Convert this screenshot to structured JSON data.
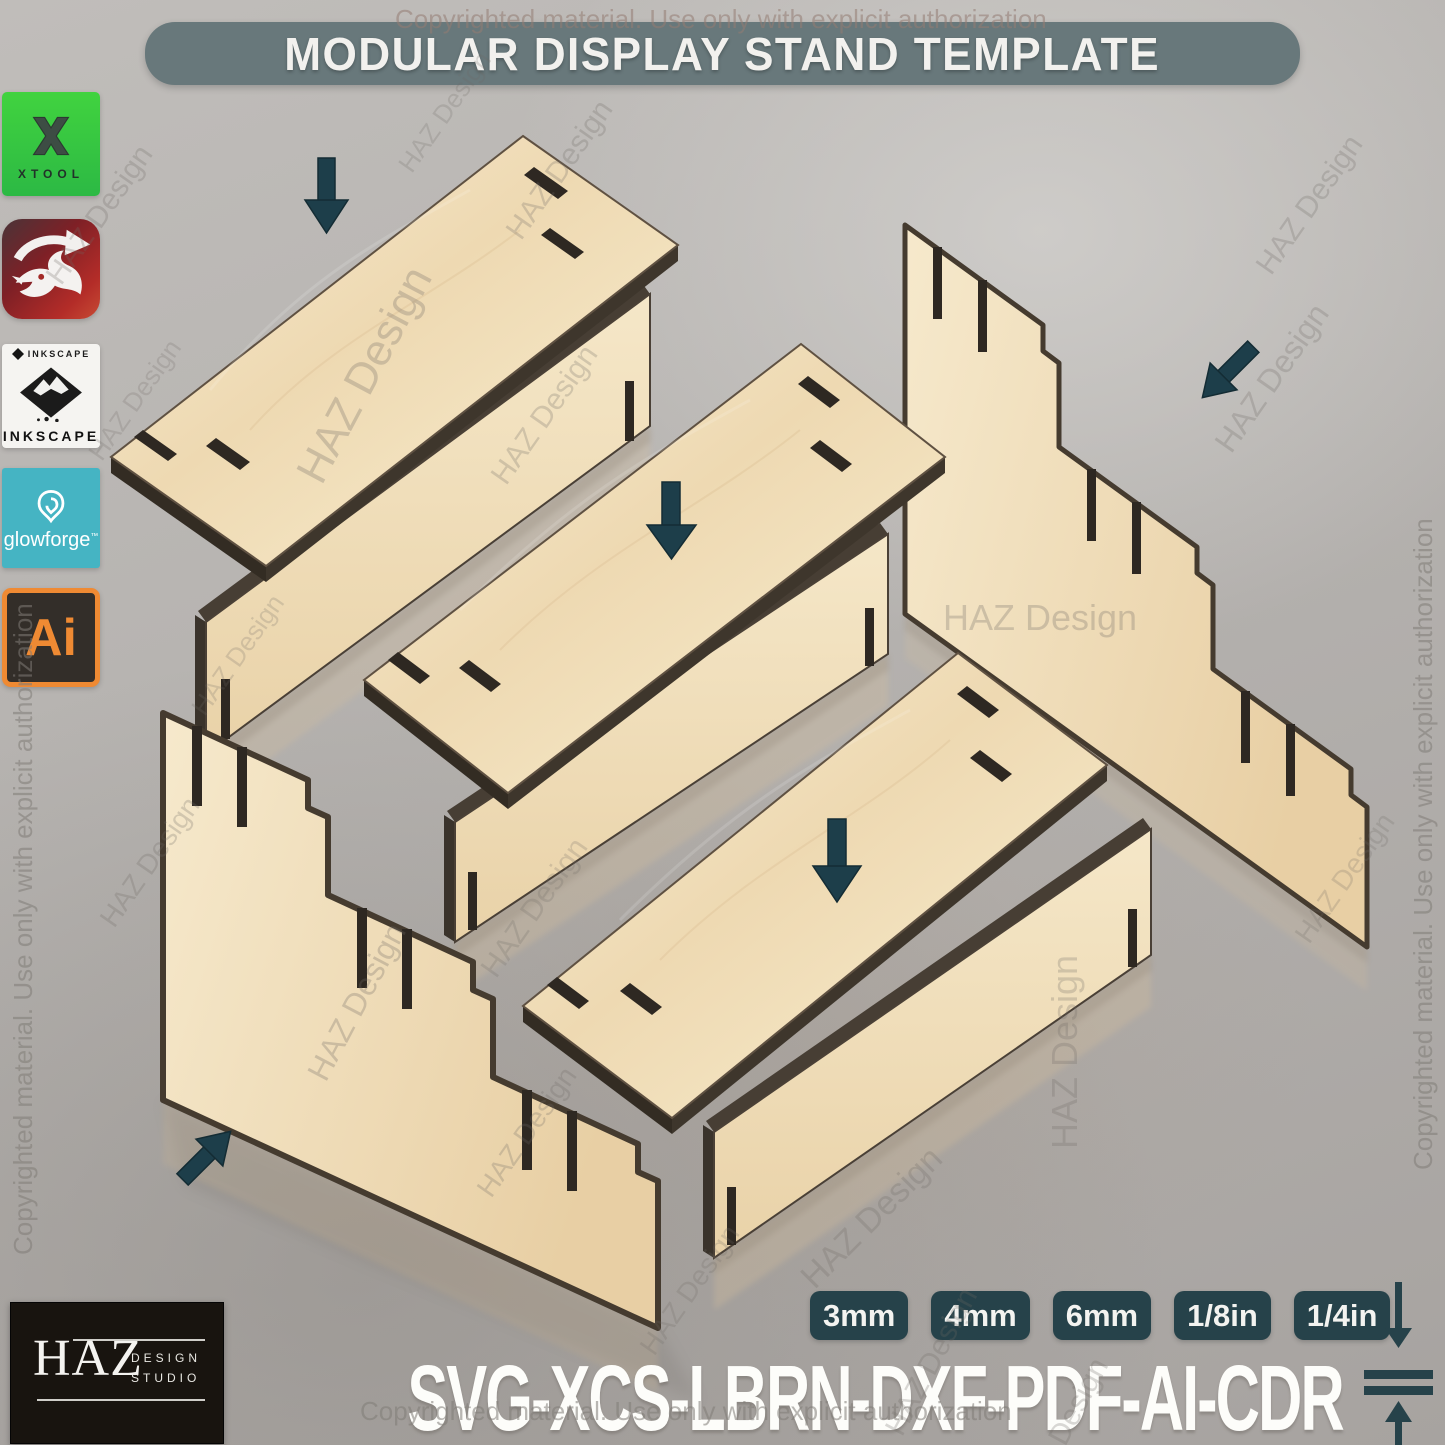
{
  "title": {
    "text": "MODULAR DISPLAY STAND TEMPLATE"
  },
  "watermark": {
    "copyright": "Copyrighted material. Use only with explicit authorization",
    "brand": "HAZ Design"
  },
  "software": [
    {
      "name": "xTool",
      "label": "XTOOL"
    },
    {
      "name": "LightBurn"
    },
    {
      "name": "Inkscape",
      "label_top": "INKSCAPE",
      "label_bottom": "INKSCAPE"
    },
    {
      "name": "Glowforge",
      "label": "glowforge",
      "tm": "™"
    },
    {
      "name": "Adobe Illustrator",
      "label": "Ai"
    }
  ],
  "thickness_badges": [
    "3mm",
    "4mm",
    "6mm",
    "1/8in",
    "1/4in"
  ],
  "formats": {
    "text": "SVG-XCS-LBRN-DXF-PDF-AI-CDR"
  },
  "brand_logo": {
    "name": "HAZ",
    "line1": "DESIGN",
    "line2": "STUDIO"
  },
  "scene": {
    "type": "exploded-assembly-render",
    "parts": [
      "shelf-top-panel x3",
      "front-riser-panel x3",
      "stepped-side-panel-left",
      "stepped-side-panel-right"
    ],
    "assembly_arrows": 5
  },
  "colors": {
    "banner_bg": "#68787b",
    "badge_bg": "#26424a",
    "arrow": "#1d3e4a",
    "wood_face": "#f0ddb9",
    "cut_edge": "#453c31",
    "ai_orange": "#ef8a33",
    "xtool_green": "#35c841",
    "glowforge_teal": "#45b4c3"
  }
}
